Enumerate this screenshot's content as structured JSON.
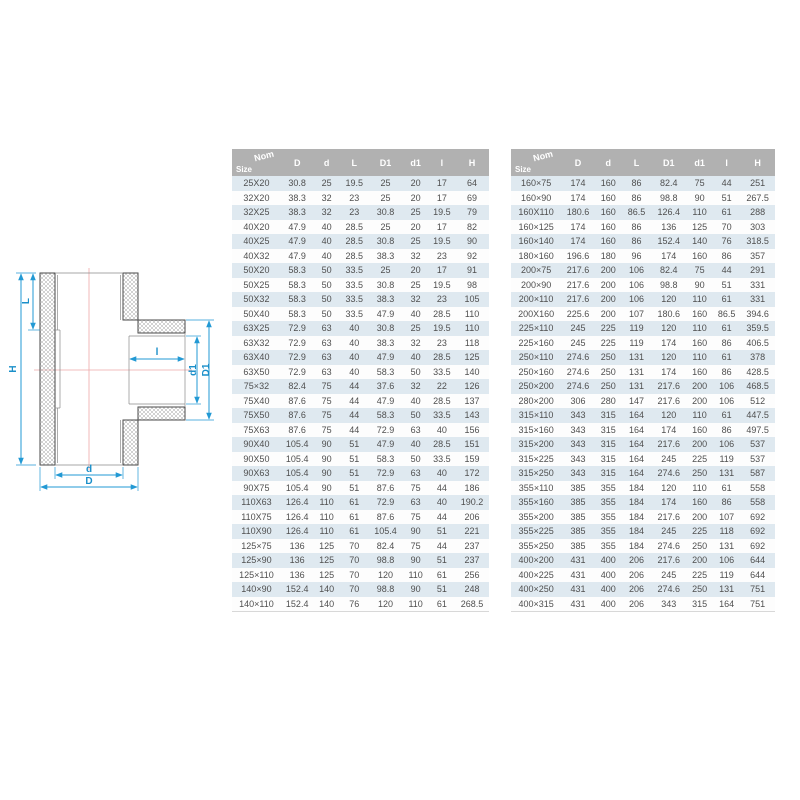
{
  "page": {
    "background": "#ffffff"
  },
  "diagram": {
    "labels": {
      "H": "H",
      "L": "L",
      "D": "D",
      "d": "d",
      "D1": "D1",
      "d1": "d1",
      "l": "l"
    },
    "colors": {
      "dimension_line": "#2299d4",
      "dimension_text": "#1a8fc9",
      "center_line": "#eda9a9",
      "outline": "#4a4a4a",
      "hatch": "#a6a6a6"
    }
  },
  "table_style": {
    "header_bg": "#b1b1b1",
    "header_text": "#ffffff",
    "row_alt_bg": "#dfe9f0",
    "row_bg": "#fdfdfd",
    "cell_text": "#4f4f4f"
  },
  "tables": [
    {
      "header": {
        "size_label": "Size",
        "nom_label": "Nom",
        "columns": [
          "D",
          "d",
          "L",
          "D1",
          "d1",
          "l",
          "H"
        ]
      },
      "rows": [
        [
          "25X20",
          "30.8",
          "25",
          "19.5",
          "25",
          "20",
          "17",
          "64"
        ],
        [
          "32X20",
          "38.3",
          "32",
          "23",
          "25",
          "20",
          "17",
          "69"
        ],
        [
          "32X25",
          "38.3",
          "32",
          "23",
          "30.8",
          "25",
          "19.5",
          "79"
        ],
        [
          "40X20",
          "47.9",
          "40",
          "28.5",
          "25",
          "20",
          "17",
          "82"
        ],
        [
          "40X25",
          "47.9",
          "40",
          "28.5",
          "30.8",
          "25",
          "19.5",
          "90"
        ],
        [
          "40X32",
          "47.9",
          "40",
          "28.5",
          "38.3",
          "32",
          "23",
          "92"
        ],
        [
          "50X20",
          "58.3",
          "50",
          "33.5",
          "25",
          "20",
          "17",
          "91"
        ],
        [
          "50X25",
          "58.3",
          "50",
          "33.5",
          "30.8",
          "25",
          "19.5",
          "98"
        ],
        [
          "50X32",
          "58.3",
          "50",
          "33.5",
          "38.3",
          "32",
          "23",
          "105"
        ],
        [
          "50X40",
          "58.3",
          "50",
          "33.5",
          "47.9",
          "40",
          "28.5",
          "110"
        ],
        [
          "63X25",
          "72.9",
          "63",
          "40",
          "30.8",
          "25",
          "19.5",
          "110"
        ],
        [
          "63X32",
          "72.9",
          "63",
          "40",
          "38.3",
          "32",
          "23",
          "118"
        ],
        [
          "63X40",
          "72.9",
          "63",
          "40",
          "47.9",
          "40",
          "28.5",
          "125"
        ],
        [
          "63X50",
          "72.9",
          "63",
          "40",
          "58.3",
          "50",
          "33.5",
          "140"
        ],
        [
          "75×32",
          "82.4",
          "75",
          "44",
          "37.6",
          "32",
          "22",
          "126"
        ],
        [
          "75X40",
          "87.6",
          "75",
          "44",
          "47.9",
          "40",
          "28.5",
          "137"
        ],
        [
          "75X50",
          "87.6",
          "75",
          "44",
          "58.3",
          "50",
          "33.5",
          "143"
        ],
        [
          "75X63",
          "87.6",
          "75",
          "44",
          "72.9",
          "63",
          "40",
          "156"
        ],
        [
          "90X40",
          "105.4",
          "90",
          "51",
          "47.9",
          "40",
          "28.5",
          "151"
        ],
        [
          "90X50",
          "105.4",
          "90",
          "51",
          "58.3",
          "50",
          "33.5",
          "159"
        ],
        [
          "90X63",
          "105.4",
          "90",
          "51",
          "72.9",
          "63",
          "40",
          "172"
        ],
        [
          "90X75",
          "105.4",
          "90",
          "51",
          "87.6",
          "75",
          "44",
          "186"
        ],
        [
          "110X63",
          "126.4",
          "110",
          "61",
          "72.9",
          "63",
          "40",
          "190.2"
        ],
        [
          "110X75",
          "126.4",
          "110",
          "61",
          "87.6",
          "75",
          "44",
          "206"
        ],
        [
          "110X90",
          "126.4",
          "110",
          "61",
          "105.4",
          "90",
          "51",
          "221"
        ],
        [
          "125×75",
          "136",
          "125",
          "70",
          "82.4",
          "75",
          "44",
          "237"
        ],
        [
          "125×90",
          "136",
          "125",
          "70",
          "98.8",
          "90",
          "51",
          "237"
        ],
        [
          "125×110",
          "136",
          "125",
          "70",
          "120",
          "110",
          "61",
          "256"
        ],
        [
          "140×90",
          "152.4",
          "140",
          "70",
          "98.8",
          "90",
          "51",
          "248"
        ],
        [
          "140×110",
          "152.4",
          "140",
          "76",
          "120",
          "110",
          "61",
          "268.5"
        ]
      ]
    },
    {
      "header": {
        "size_label": "Size",
        "nom_label": "Nom",
        "columns": [
          "D",
          "d",
          "L",
          "D1",
          "d1",
          "l",
          "H"
        ]
      },
      "rows": [
        [
          "160×75",
          "174",
          "160",
          "86",
          "82.4",
          "75",
          "44",
          "251"
        ],
        [
          "160×90",
          "174",
          "160",
          "86",
          "98.8",
          "90",
          "51",
          "267.5"
        ],
        [
          "160X110",
          "180.6",
          "160",
          "86.5",
          "126.4",
          "110",
          "61",
          "288"
        ],
        [
          "160×125",
          "174",
          "160",
          "86",
          "136",
          "125",
          "70",
          "303"
        ],
        [
          "160×140",
          "174",
          "160",
          "86",
          "152.4",
          "140",
          "76",
          "318.5"
        ],
        [
          "180×160",
          "196.6",
          "180",
          "96",
          "174",
          "160",
          "86",
          "357"
        ],
        [
          "200×75",
          "217.6",
          "200",
          "106",
          "82.4",
          "75",
          "44",
          "291"
        ],
        [
          "200×90",
          "217.6",
          "200",
          "106",
          "98.8",
          "90",
          "51",
          "331"
        ],
        [
          "200×110",
          "217.6",
          "200",
          "106",
          "120",
          "110",
          "61",
          "331"
        ],
        [
          "200X160",
          "225.6",
          "200",
          "107",
          "180.6",
          "160",
          "86.5",
          "394.6"
        ],
        [
          "225×110",
          "245",
          "225",
          "119",
          "120",
          "110",
          "61",
          "359.5"
        ],
        [
          "225×160",
          "245",
          "225",
          "119",
          "174",
          "160",
          "86",
          "406.5"
        ],
        [
          "250×110",
          "274.6",
          "250",
          "131",
          "120",
          "110",
          "61",
          "378"
        ],
        [
          "250×160",
          "274.6",
          "250",
          "131",
          "174",
          "160",
          "86",
          "428.5"
        ],
        [
          "250×200",
          "274.6",
          "250",
          "131",
          "217.6",
          "200",
          "106",
          "468.5"
        ],
        [
          "280×200",
          "306",
          "280",
          "147",
          "217.6",
          "200",
          "106",
          "512"
        ],
        [
          "315×110",
          "343",
          "315",
          "164",
          "120",
          "110",
          "61",
          "447.5"
        ],
        [
          "315×160",
          "343",
          "315",
          "164",
          "174",
          "160",
          "86",
          "497.5"
        ],
        [
          "315×200",
          "343",
          "315",
          "164",
          "217.6",
          "200",
          "106",
          "537"
        ],
        [
          "315×225",
          "343",
          "315",
          "164",
          "245",
          "225",
          "119",
          "537"
        ],
        [
          "315×250",
          "343",
          "315",
          "164",
          "274.6",
          "250",
          "131",
          "587"
        ],
        [
          "355×110",
          "385",
          "355",
          "184",
          "120",
          "110",
          "61",
          "558"
        ],
        [
          "355×160",
          "385",
          "355",
          "184",
          "174",
          "160",
          "86",
          "558"
        ],
        [
          "355×200",
          "385",
          "355",
          "184",
          "217.6",
          "200",
          "107",
          "692"
        ],
        [
          "355×225",
          "385",
          "355",
          "184",
          "245",
          "225",
          "118",
          "692"
        ],
        [
          "355×250",
          "385",
          "355",
          "184",
          "274.6",
          "250",
          "131",
          "692"
        ],
        [
          "400×200",
          "431",
          "400",
          "206",
          "217.6",
          "200",
          "106",
          "644"
        ],
        [
          "400×225",
          "431",
          "400",
          "206",
          "245",
          "225",
          "119",
          "644"
        ],
        [
          "400×250",
          "431",
          "400",
          "206",
          "274.6",
          "250",
          "131",
          "751"
        ],
        [
          "400×315",
          "431",
          "400",
          "206",
          "343",
          "315",
          "164",
          "751"
        ]
      ]
    }
  ]
}
